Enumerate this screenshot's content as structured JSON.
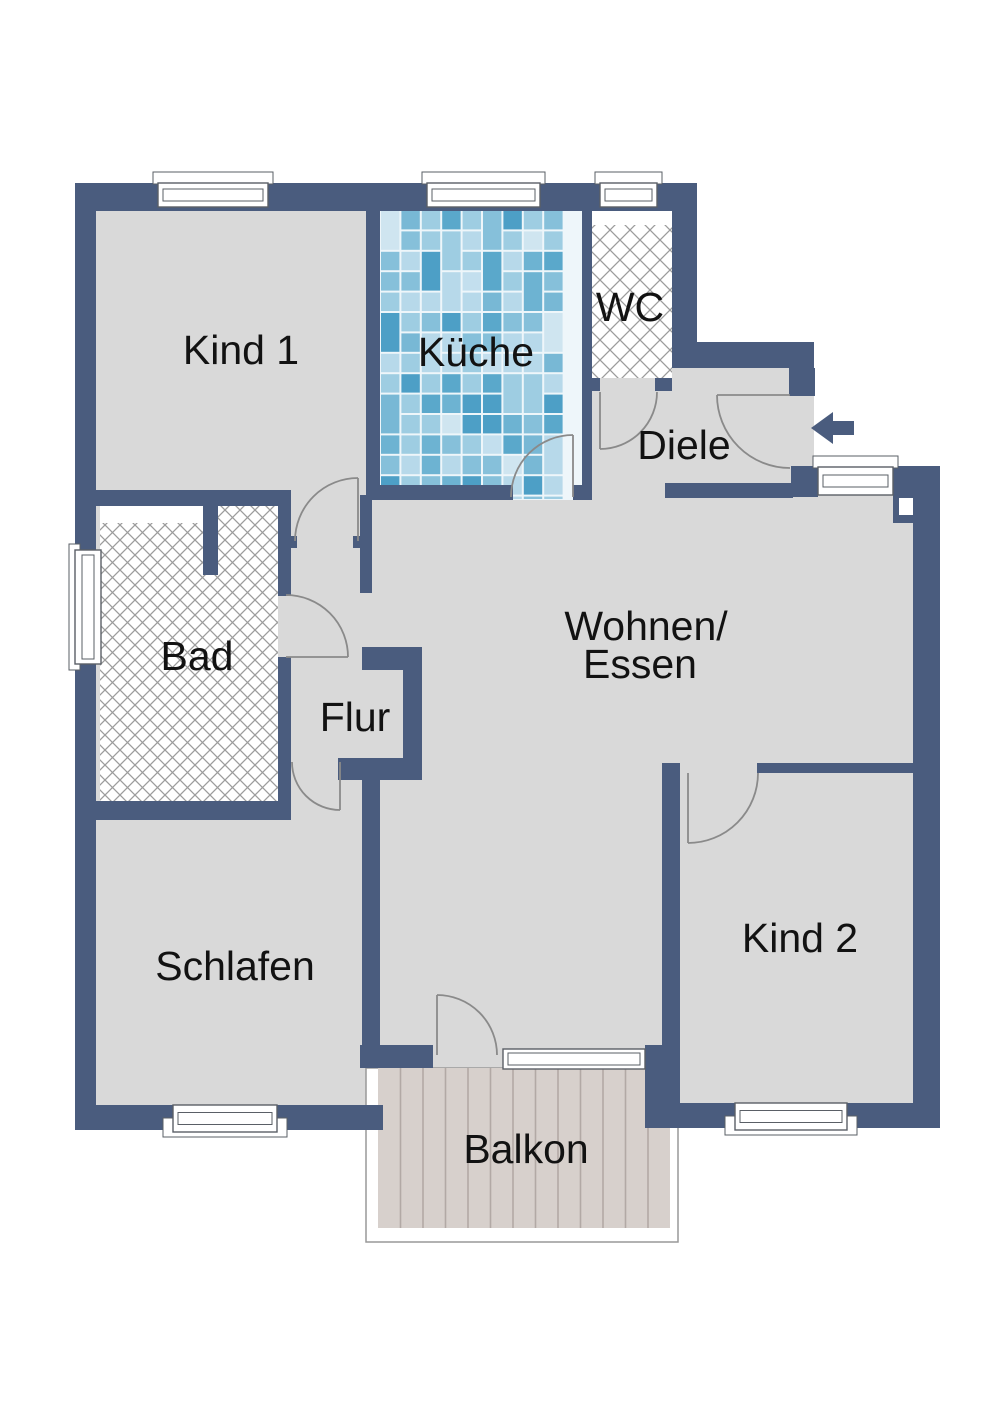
{
  "floorplan": {
    "canvas": {
      "width": 1000,
      "height": 1415
    },
    "colors": {
      "background": "#ffffff",
      "wall": "#4a5c7e",
      "floor": "#d9d9d9",
      "text": "#121212",
      "door_arc": "#8a8a8a",
      "window_border": "#5a5f66",
      "window_fill": "#ffffff",
      "hatch_line": "#9c9c9c",
      "tile_grout": "#eef6fa",
      "tile_palette": [
        "#cfe5f0",
        "#b7d9ea",
        "#9ecde2",
        "#86c0da",
        "#6db3d2",
        "#5aa8cb",
        "#9ecde2",
        "#b7d9ea",
        "#86c0da",
        "#4d9fc6",
        "#c3dfee",
        "#78b8d5"
      ],
      "plank_fill": "#d7d0cc",
      "plank_line": "#b2a9a5",
      "balcony_outline": "#999999",
      "arrow": "#4a5c7e"
    },
    "silhouette": "75,183 697,183 697,342 814,342 814,466 940,466 940,1128 645,1128 645,1068 382,1068 382,1130 75,1130",
    "walls": [
      {
        "id": "ext-left",
        "r": [
          75,
          183,
          21,
          947
        ]
      },
      {
        "id": "ext-top",
        "r": [
          75,
          183,
          622,
          28
        ]
      },
      {
        "id": "wc-right",
        "r": [
          672,
          203,
          25,
          145
        ]
      },
      {
        "id": "diele-top",
        "r": [
          672,
          342,
          142,
          26
        ]
      },
      {
        "id": "entry-jamb-top",
        "r": [
          789,
          368,
          26,
          28
        ]
      },
      {
        "id": "entry-jamb-bottom",
        "r": [
          791,
          466,
          27,
          31
        ]
      },
      {
        "id": "corner-right-top",
        "r": [
          893,
          466,
          47,
          57
        ]
      },
      {
        "id": "ext-right",
        "r": [
          913,
          466,
          27,
          662
        ]
      },
      {
        "id": "kind2-bottom-left",
        "r": [
          645,
          1103,
          91,
          25
        ]
      },
      {
        "id": "kind2-bottom-right",
        "r": [
          847,
          1103,
          93,
          25
        ]
      },
      {
        "id": "schlafen-bottom-left",
        "r": [
          75,
          1105,
          99,
          25
        ]
      },
      {
        "id": "schlafen-bottom-right",
        "r": [
          277,
          1105,
          106,
          25
        ]
      },
      {
        "id": "divider-kind1-kueche",
        "r": [
          366,
          203,
          14,
          293
        ]
      },
      {
        "id": "divider-lower",
        "r": [
          360,
          495,
          12,
          98
        ]
      },
      {
        "id": "doorstop-flur-right",
        "r": [
          353,
          536,
          8,
          12
        ]
      },
      {
        "id": "kind1-bottom",
        "r": [
          95,
          490,
          196,
          16
        ]
      },
      {
        "id": "bad-right-upper",
        "r": [
          278,
          490,
          13,
          106
        ]
      },
      {
        "id": "doorstop-bad",
        "r": [
          290,
          536,
          7,
          12
        ]
      },
      {
        "id": "bad-right-lower",
        "r": [
          278,
          657,
          13,
          147
        ]
      },
      {
        "id": "bad-bottom",
        "r": [
          95,
          801,
          196,
          19
        ]
      },
      {
        "id": "bad-stub",
        "r": [
          203,
          505,
          15,
          70
        ]
      },
      {
        "id": "divider-kueche-wc",
        "r": [
          582,
          203,
          10,
          297
        ]
      },
      {
        "id": "kueche-bottom",
        "r": [
          366,
          485,
          147,
          15
        ]
      },
      {
        "id": "kueche-jamb",
        "r": [
          573,
          485,
          9,
          15
        ]
      },
      {
        "id": "wc-bottom-left",
        "r": [
          588,
          378,
          12,
          13
        ]
      },
      {
        "id": "wc-bottom-right",
        "r": [
          655,
          378,
          17,
          13
        ]
      },
      {
        "id": "diele-bottom",
        "r": [
          665,
          483,
          128,
          15
        ]
      },
      {
        "id": "flur-nook-top",
        "r": [
          362,
          647,
          60,
          23
        ]
      },
      {
        "id": "flur-nook-right",
        "r": [
          403,
          670,
          19,
          88
        ]
      },
      {
        "id": "flur-nook-bottom",
        "r": [
          338,
          758,
          84,
          22
        ]
      },
      {
        "id": "schlafen-right",
        "r": [
          362,
          780,
          18,
          288
        ]
      },
      {
        "id": "wohnen-balkon-left",
        "r": [
          360,
          1045,
          73,
          23
        ]
      },
      {
        "id": "kind2-block",
        "r": [
          645,
          1045,
          35,
          58
        ]
      },
      {
        "id": "kind2-left",
        "r": [
          662,
          763,
          18,
          284
        ]
      },
      {
        "id": "kind2-top",
        "r": [
          757,
          763,
          156,
          10
        ]
      }
    ],
    "niches": [
      {
        "id": "shaft-right-corner",
        "r": [
          899,
          498,
          14,
          17
        ]
      }
    ],
    "tiles": {
      "r": [
        380,
        210,
        202,
        290
      ],
      "cell": 20.4,
      "seed": 7
    },
    "hatch_areas": [
      {
        "id": "wc-floor",
        "r": [
          592,
          225,
          80,
          153
        ],
        "size": 20
      },
      {
        "id": "bad-floor",
        "r": [
          100,
          505,
          178,
          296
        ],
        "size": 15
      }
    ],
    "white_patches": [
      {
        "id": "wc-shelf",
        "r": [
          592,
          210,
          80,
          15
        ]
      },
      {
        "id": "bad-shelf",
        "r": [
          100,
          505,
          103,
          18
        ]
      }
    ],
    "balcony": {
      "outline": [
        366,
        1068,
        312,
        174
      ],
      "planks": [
        378,
        1068,
        292,
        160
      ],
      "plank_step": 22.5
    },
    "windows": [
      {
        "id": "kind1-window",
        "r": [
          158,
          183,
          110,
          24
        ],
        "sill": "above"
      },
      {
        "id": "kueche-window",
        "r": [
          427,
          183,
          113,
          24
        ],
        "sill": "above"
      },
      {
        "id": "wc-window",
        "r": [
          600,
          183,
          57,
          24
        ],
        "sill": "above"
      },
      {
        "id": "wohnen-east-window",
        "r": [
          818,
          467,
          75,
          28
        ],
        "sill": "above"
      },
      {
        "id": "balkon-fixed-glazing",
        "r": [
          503,
          1049,
          142,
          20
        ],
        "sill": "none"
      },
      {
        "id": "schlafen-window",
        "r": [
          173,
          1105,
          104,
          27
        ],
        "sill": "below"
      },
      {
        "id": "kind2-window",
        "r": [
          735,
          1103,
          112,
          27
        ],
        "sill": "below"
      },
      {
        "id": "bad-window",
        "r": [
          75,
          550,
          26,
          114
        ],
        "sill": "left",
        "vertical": true
      }
    ],
    "doors": [
      {
        "id": "kind1-door",
        "sx": 358,
        "sy": 478,
        "r": 63,
        "sw": 0,
        "ex": 295,
        "ey": 541,
        "leaf": [
          358,
          541,
          358,
          478
        ]
      },
      {
        "id": "bad-door",
        "sx": 286,
        "sy": 595,
        "r": 62,
        "sw": 1,
        "ex": 348,
        "ey": 657,
        "leaf": [
          286,
          657,
          348,
          657
        ]
      },
      {
        "id": "schlafen-door",
        "sx": 292,
        "sy": 762,
        "r": 48,
        "sw": 0,
        "ex": 340,
        "ey": 810,
        "leaf": [
          340,
          762,
          340,
          810
        ]
      },
      {
        "id": "balkon-door",
        "sx": 437,
        "sy": 995,
        "r": 60,
        "sw": 1,
        "ex": 497,
        "ey": 1055,
        "leaf": [
          437,
          1055,
          437,
          995
        ]
      },
      {
        "id": "kueche-door",
        "sx": 511,
        "sy": 497,
        "r": 62,
        "sw": 1,
        "ex": 573,
        "ey": 435,
        "leaf": [
          573,
          497,
          573,
          435
        ]
      },
      {
        "id": "wc-door",
        "sx": 657,
        "sy": 392,
        "r": 57,
        "sw": 1,
        "ex": 600,
        "ey": 449,
        "leaf": [
          600,
          392,
          600,
          449
        ]
      },
      {
        "id": "entry-door",
        "sx": 717,
        "sy": 395,
        "r": 73,
        "sw": 0,
        "ex": 790,
        "ey": 468,
        "leaf": [
          790,
          395,
          717,
          395
        ]
      },
      {
        "id": "kind2-door",
        "sx": 758,
        "sy": 773,
        "r": 70,
        "sw": 1,
        "ex": 688,
        "ey": 843,
        "leaf": [
          688,
          773,
          688,
          843
        ]
      }
    ],
    "entry_arrow": {
      "points": "811,428 833,412 833,421 854,421 854,435 833,435 833,444"
    },
    "labels": [
      {
        "id": "kind1",
        "text": "Kind 1",
        "x": 241,
        "y": 350,
        "size": 41
      },
      {
        "id": "kueche",
        "text": "Küche",
        "x": 476,
        "y": 352,
        "size": 41
      },
      {
        "id": "wc",
        "text": "WC",
        "x": 630,
        "y": 307,
        "size": 41
      },
      {
        "id": "diele",
        "text": "Diele",
        "x": 684,
        "y": 445,
        "size": 41
      },
      {
        "id": "wohnen-line1",
        "text": "Wohnen/",
        "x": 646,
        "y": 626,
        "size": 41
      },
      {
        "id": "wohnen-line2",
        "text": "Essen",
        "x": 640,
        "y": 664,
        "size": 41
      },
      {
        "id": "bad",
        "text": "Bad",
        "x": 197,
        "y": 656,
        "size": 41
      },
      {
        "id": "flur",
        "text": "Flur",
        "x": 355,
        "y": 717,
        "size": 41
      },
      {
        "id": "schlafen",
        "text": "Schlafen",
        "x": 235,
        "y": 966,
        "size": 41
      },
      {
        "id": "kind2",
        "text": "Kind 2",
        "x": 800,
        "y": 938,
        "size": 41
      },
      {
        "id": "balkon",
        "text": "Balkon",
        "x": 526,
        "y": 1149,
        "size": 41
      }
    ]
  }
}
